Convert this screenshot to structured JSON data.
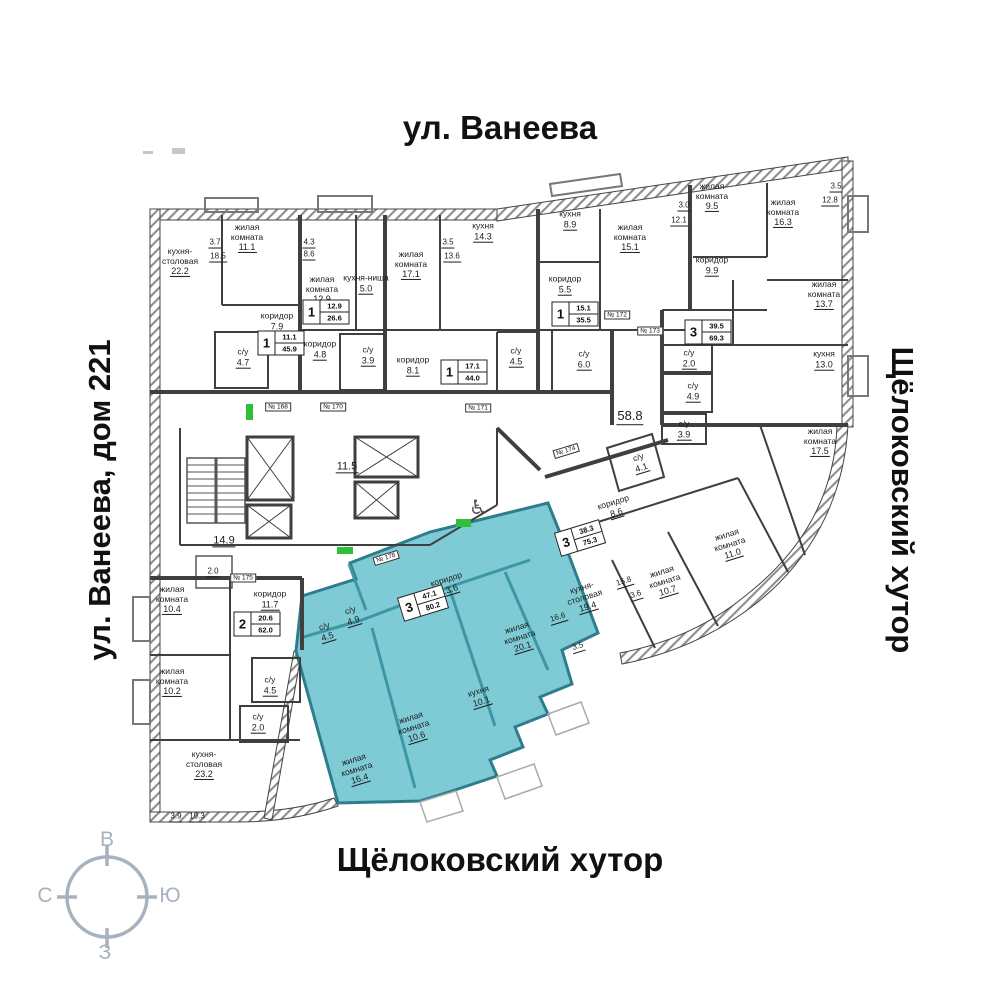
{
  "titles": {
    "top": "ул. Ванеева",
    "left": "ул. Ванеева, дом 221",
    "right": "Щёлоковский хутор",
    "bottom": "Щёлоковский хутор"
  },
  "compass": {
    "top": "В",
    "right": "Ю",
    "left": "С",
    "bottom": "З"
  },
  "colors": {
    "highlight_fill": "#7ECBD5",
    "highlight_wall": "#2E7D8C",
    "walls": "#3F3F3F",
    "compass": "#A7B2BF",
    "entry_marker": "#2FBF3A"
  },
  "plan": {
    "labels": [
      {
        "n": "жилая\nкомната",
        "a": "11.1",
        "x": 247,
        "y": 238
      },
      {
        "n": "кухня-\nстоловая",
        "a": "22.2",
        "x": 180,
        "y": 262
      },
      {
        "a": "3.7",
        "x": 215,
        "y": 243,
        "s": "dim"
      },
      {
        "a": "18.5",
        "x": 218,
        "y": 257,
        "s": "dim"
      },
      {
        "n": "коридор",
        "a": "7.9",
        "x": 277,
        "y": 322
      },
      {
        "n": "с/у",
        "a": "4.7",
        "x": 243,
        "y": 358
      },
      {
        "n": "жилая\nкомната",
        "a": "12.9",
        "x": 322,
        "y": 290
      },
      {
        "a": "4.3",
        "x": 309,
        "y": 243,
        "s": "dim"
      },
      {
        "a": "8.6",
        "x": 309,
        "y": 255,
        "s": "dim"
      },
      {
        "n": "кухня-ниша",
        "a": "5.0",
        "x": 366,
        "y": 284
      },
      {
        "n": "коридор",
        "a": "4.8",
        "x": 320,
        "y": 350
      },
      {
        "n": "с/у",
        "a": "3.9",
        "x": 368,
        "y": 356
      },
      {
        "n": "жилая\nкомната",
        "a": "17.1",
        "x": 411,
        "y": 265
      },
      {
        "a": "3.5",
        "x": 448,
        "y": 243,
        "s": "dim"
      },
      {
        "a": "13.6",
        "x": 452,
        "y": 257,
        "s": "dim"
      },
      {
        "n": "коридор",
        "a": "8.1",
        "x": 413,
        "y": 366
      },
      {
        "n": "кухня",
        "a": "14.3",
        "x": 483,
        "y": 232
      },
      {
        "n": "с/у",
        "a": "4.5",
        "x": 516,
        "y": 357
      },
      {
        "n": "кухня",
        "a": "8.9",
        "x": 570,
        "y": 220
      },
      {
        "n": "коридор",
        "a": "5.5",
        "x": 565,
        "y": 285
      },
      {
        "n": "жилая\nкомната",
        "a": "15.1",
        "x": 630,
        "y": 238
      },
      {
        "a": "3.0",
        "x": 684,
        "y": 206,
        "s": "dim"
      },
      {
        "a": "12.1",
        "x": 679,
        "y": 221,
        "s": "dim"
      },
      {
        "n": "с/у",
        "a": "6.0",
        "x": 584,
        "y": 360
      },
      {
        "a": "58.8",
        "x": 630,
        "y": 417,
        "s": "big"
      },
      {
        "n": "жилая\nкомната",
        "a": "9.5",
        "x": 712,
        "y": 197
      },
      {
        "n": "жилая\nкомната",
        "a": "16.3",
        "x": 783,
        "y": 213
      },
      {
        "a": "3.5",
        "x": 836,
        "y": 187,
        "s": "dim"
      },
      {
        "a": "12.8",
        "x": 830,
        "y": 201,
        "s": "dim"
      },
      {
        "n": "коридор",
        "a": "9.9",
        "x": 712,
        "y": 266
      },
      {
        "n": "жилая\nкомната",
        "a": "13.7",
        "x": 824,
        "y": 295
      },
      {
        "n": "кухня",
        "a": "13.0",
        "x": 824,
        "y": 360
      },
      {
        "n": "с/у",
        "a": "2.0",
        "x": 689,
        "y": 359
      },
      {
        "n": "с/у",
        "a": "4.9",
        "x": 693,
        "y": 392
      },
      {
        "n": "с/у",
        "a": "3.9",
        "x": 684,
        "y": 430
      },
      {
        "n": "жилая\nкомната",
        "a": "17.5",
        "x": 820,
        "y": 442
      },
      {
        "n": "с/у",
        "a": "4.1",
        "x": 640,
        "y": 463,
        "r": -17
      },
      {
        "n": "коридор",
        "a": "8.6",
        "x": 615,
        "y": 508,
        "r": -17
      },
      {
        "n": "кухня-\nстоловая",
        "a": "19.4",
        "x": 585,
        "y": 598,
        "r": -17
      },
      {
        "a": "15.8",
        "x": 624,
        "y": 582,
        "s": "dim",
        "r": -17
      },
      {
        "a": "3.6",
        "x": 636,
        "y": 595,
        "s": "dim",
        "r": -17
      },
      {
        "n": "жилая\nкомната",
        "a": "10.7",
        "x": 665,
        "y": 582,
        "r": -17
      },
      {
        "n": "жилая\nкомната",
        "a": "11.0",
        "x": 730,
        "y": 545,
        "r": -17
      },
      {
        "n": "коридор",
        "a": "13.6",
        "x": 448,
        "y": 585,
        "r": -17
      },
      {
        "n": "с/у",
        "a": "4.9",
        "x": 352,
        "y": 616,
        "r": -17
      },
      {
        "n": "с/у",
        "a": "4.5",
        "x": 326,
        "y": 632,
        "r": -17
      },
      {
        "n": "жилая\nкомната",
        "a": "20.1",
        "x": 520,
        "y": 638,
        "r": -17
      },
      {
        "a": "16.6",
        "x": 558,
        "y": 618,
        "s": "dim",
        "r": -17
      },
      {
        "a": "3.5",
        "x": 578,
        "y": 647,
        "s": "dim",
        "r": -17
      },
      {
        "n": "кухня",
        "a": "10.1",
        "x": 480,
        "y": 697,
        "r": -17
      },
      {
        "n": "жилая\nкомната",
        "a": "10.6",
        "x": 414,
        "y": 728,
        "r": -17
      },
      {
        "n": "жилая\nкомната",
        "a": "16.4",
        "x": 357,
        "y": 770,
        "r": -17
      },
      {
        "n": "жилая\nкомната",
        "a": "10.4",
        "x": 172,
        "y": 600
      },
      {
        "n": "жилая\nкомната",
        "a": "10.2",
        "x": 172,
        "y": 682
      },
      {
        "n": "коридор",
        "a": "11.7",
        "x": 270,
        "y": 600
      },
      {
        "n": "с/у",
        "a": "4.5",
        "x": 270,
        "y": 686
      },
      {
        "n": "с/у",
        "a": "2.0",
        "x": 258,
        "y": 723
      },
      {
        "n": "кухня-\nстоловая",
        "a": "23.2",
        "x": 204,
        "y": 765
      },
      {
        "a": "3.9",
        "x": 176,
        "y": 817,
        "s": "dim"
      },
      {
        "a": "19.3",
        "x": 197,
        "y": 817,
        "s": "dim"
      },
      {
        "a": "14.9",
        "x": 224,
        "y": 541,
        "s": "mid"
      },
      {
        "a": "11.5",
        "x": 347,
        "y": 467,
        "s": "mid"
      },
      {
        "a": "2.0",
        "x": 213,
        "y": 572,
        "s": "dim"
      }
    ],
    "badges": [
      {
        "rooms": "1",
        "living": "11.1",
        "total": "45.9",
        "x": 281,
        "y": 343
      },
      {
        "rooms": "1",
        "living": "12.9",
        "total": "26.6",
        "x": 326,
        "y": 312
      },
      {
        "rooms": "1",
        "living": "17.1",
        "total": "44.0",
        "x": 464,
        "y": 372
      },
      {
        "rooms": "1",
        "living": "15.1",
        "total": "35.5",
        "x": 575,
        "y": 314
      },
      {
        "rooms": "3",
        "living": "39.5",
        "total": "69.3",
        "x": 708,
        "y": 332
      },
      {
        "rooms": "3",
        "living": "38.3",
        "total": "75.3",
        "x": 580,
        "y": 538,
        "r": -17
      },
      {
        "rooms": "3",
        "living": "47.1",
        "total": "80.2",
        "x": 423,
        "y": 603,
        "r": -17
      },
      {
        "rooms": "2",
        "living": "20.6",
        "total": "62.0",
        "x": 257,
        "y": 624
      }
    ],
    "door_tags": [
      {
        "text": "№ 168",
        "x": 278,
        "y": 407
      },
      {
        "text": "№ 170",
        "x": 333,
        "y": 407
      },
      {
        "text": "№ 171",
        "x": 478,
        "y": 408
      },
      {
        "text": "№ 172",
        "x": 617,
        "y": 315
      },
      {
        "text": "№ 173",
        "x": 650,
        "y": 331
      },
      {
        "text": "№ 174",
        "x": 566,
        "y": 451,
        "r": -17
      },
      {
        "text": "№ 175",
        "x": 243,
        "y": 578
      },
      {
        "text": "№ 178",
        "x": 386,
        "y": 558,
        "r": -17
      }
    ]
  }
}
